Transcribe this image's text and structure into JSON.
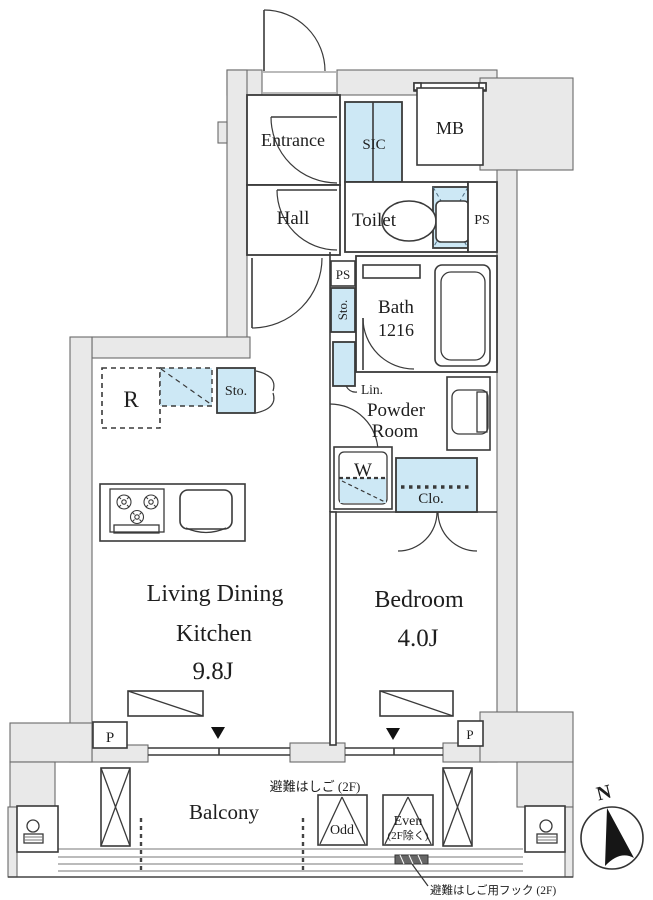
{
  "colors": {
    "wall_gray": "#e9e9e9",
    "accent_blue": "#cde8f5",
    "line_dark": "#3a3a3a"
  },
  "plan": {
    "upper": {
      "entrance": "Entrance",
      "sic": "SIC",
      "meter_box": "MB",
      "hall": "Hall",
      "toilet": "Toilet",
      "pipe_shaft": "PS",
      "pipe_shaft_small": "PS",
      "hall_storage": "Sto."
    },
    "water": {
      "bath": "Bath",
      "bath_size": "1216",
      "linen": "Lin.",
      "powder_room_line1": "Powder",
      "powder_room_line2": "Room",
      "washer": "W",
      "closet": "Clo."
    },
    "kitchen": {
      "fridge": "R",
      "storage": "Sto."
    },
    "main_rooms": {
      "ldk_line1": "Living Dining",
      "ldk_line2": "Kitchen",
      "ldk_size": "9.8J",
      "bedroom": "Bedroom",
      "bedroom_size": "4.0J"
    },
    "balcony": {
      "label": "Balcony",
      "pillar_left": "P",
      "pillar_right": "P",
      "escape_ladder_note": "避難はしご (2F)",
      "hatch_odd": "Odd",
      "hatch_even_line1": "Even",
      "hatch_even_line2": "(2F除く)",
      "escape_hook_note": "避難はしご用フック (2F)"
    },
    "compass": {
      "north": "N"
    }
  }
}
